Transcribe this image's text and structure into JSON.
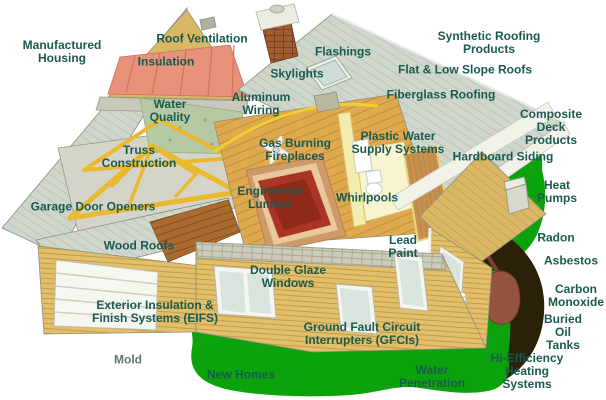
{
  "title": "House cutaway inspection-topics diagram",
  "colors": {
    "background": "#ffffff",
    "label_text": "#1a5a50",
    "grass": "#0ca20c",
    "soil": "#2b2008",
    "roof_shingle": "#cfd7cd",
    "siding_tan": "#e2bf6b",
    "insulation_coral": "#e8917b",
    "truss_yellow": "#e9b92e",
    "rug_red": "#ab3524",
    "oil_tank_brown": "#94543f"
  },
  "labels": [
    {
      "id": "manufactured-housing",
      "text": "Manufactured\nHousing",
      "x": 62,
      "y": 52
    },
    {
      "id": "roof-ventilation",
      "text": "Roof Ventilation",
      "x": 202,
      "y": 39
    },
    {
      "id": "insulation",
      "text": "Insulation",
      "x": 166,
      "y": 62
    },
    {
      "id": "flashings",
      "text": "Flashings",
      "x": 343,
      "y": 52
    },
    {
      "id": "synthetic-roofing-products",
      "text": "Synthetic Roofing Products",
      "x": 489,
      "y": 43
    },
    {
      "id": "skylights",
      "text": "Skylights",
      "x": 297,
      "y": 74
    },
    {
      "id": "flat-low-slope-roofs",
      "text": "Flat & Low Slope Roofs",
      "x": 465,
      "y": 70
    },
    {
      "id": "water-quality",
      "text": "Water\nQuality",
      "x": 170,
      "y": 111
    },
    {
      "id": "aluminum-wiring",
      "text": "Aluminum\nWiring",
      "x": 261,
      "y": 104
    },
    {
      "id": "fiberglass-roofing",
      "text": "Fiberglass Roofing",
      "x": 441,
      "y": 95
    },
    {
      "id": "gas-burning-fireplaces",
      "text": "Gas Burning\nFireplaces",
      "x": 295,
      "y": 150
    },
    {
      "id": "plastic-water-supply-systems",
      "text": "Plastic Water\nSupply Systems",
      "x": 398,
      "y": 143
    },
    {
      "id": "composite-deck-products",
      "text": "Composite Deck\nProducts",
      "x": 551,
      "y": 128
    },
    {
      "id": "hardboard-siding",
      "text": "Hardboard Siding",
      "x": 503,
      "y": 157
    },
    {
      "id": "truss-construction",
      "text": "Truss\nConstruction",
      "x": 139,
      "y": 157
    },
    {
      "id": "heat-pumps",
      "text": "Heat\nPumps",
      "x": 557,
      "y": 192
    },
    {
      "id": "engineered-lumber",
      "text": "Engineered\nLumber",
      "x": 270,
      "y": 198
    },
    {
      "id": "whirlpools",
      "text": "Whirlpools",
      "x": 367,
      "y": 198
    },
    {
      "id": "garage-door-openers",
      "text": "Garage Door Openers",
      "x": 93,
      "y": 207
    },
    {
      "id": "radon",
      "text": "Radon",
      "x": 556,
      "y": 238
    },
    {
      "id": "wood-roofs",
      "text": "Wood Roofs",
      "x": 139,
      "y": 246
    },
    {
      "id": "lead-paint",
      "text": "Lead\nPaint",
      "x": 403,
      "y": 247
    },
    {
      "id": "asbestos",
      "text": "Asbestos",
      "x": 571,
      "y": 261
    },
    {
      "id": "double-glaze-windows",
      "text": "Double Glaze\nWindows",
      "x": 288,
      "y": 277
    },
    {
      "id": "carbon-monoxide",
      "text": "Carbon\nMonoxide",
      "x": 576,
      "y": 296
    },
    {
      "id": "exterior-insulation-finish-systems",
      "text": "Exterior Insulation &\nFinish Systems (EIFS)",
      "x": 155,
      "y": 312
    },
    {
      "id": "buried-oil-tanks",
      "text": "Buried\nOil Tanks",
      "x": 563,
      "y": 333
    },
    {
      "id": "ground-fault-circuit-interrupters",
      "text": "Ground Fault Circuit\nInterrupters (GFCIs)",
      "x": 362,
      "y": 334
    },
    {
      "id": "mold",
      "text": "Mold",
      "x": 128,
      "y": 360,
      "muted": true
    },
    {
      "id": "new-homes",
      "text": "New Homes",
      "x": 241,
      "y": 375
    },
    {
      "id": "water-penetration",
      "text": "Water\nPenetration",
      "x": 432,
      "y": 377
    },
    {
      "id": "hi-efficiency-heating-systems",
      "text": "Hi-Efficiency\nHeating Systems",
      "x": 527,
      "y": 372
    }
  ]
}
